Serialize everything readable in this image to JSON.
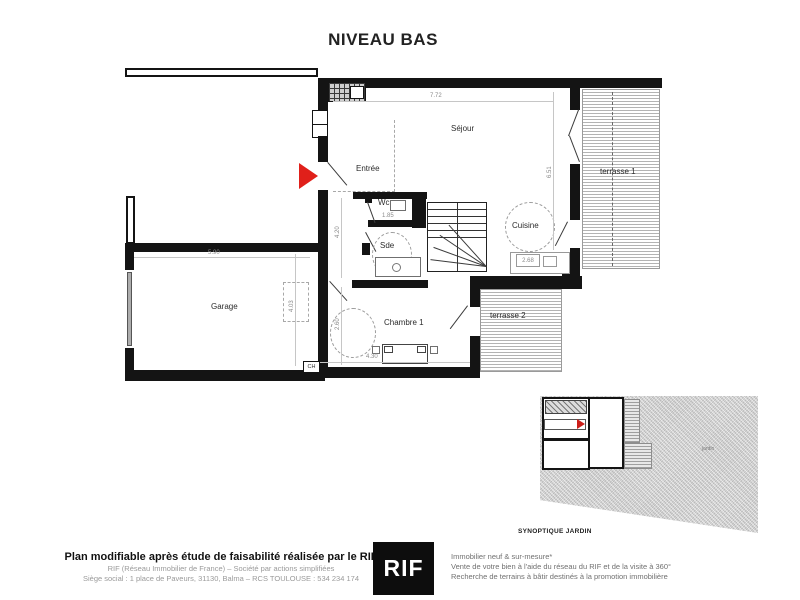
{
  "title": "NIVEAU BAS",
  "plan": {
    "rooms": {
      "sejour": "Séjour",
      "entree": "Entrée",
      "wc": "Wc",
      "sde": "Sde",
      "cuisine": "Cuisine",
      "garage": "Garage",
      "chambre1": "Chambre 1",
      "terrasse1": "terrasse 1",
      "terrasse2": "terrasse 2"
    },
    "dimensions": {
      "sejour_width": "7.72",
      "sejour_height": "6.51",
      "garage_width": "5.90",
      "entree_height": "4.20",
      "sde_width": "1.85",
      "cuisine_unit": "2.68",
      "chambre_width": "4.30",
      "chambre_height": "2.60",
      "garage_depth": "4.03"
    },
    "annotations": {
      "boiler": "CH"
    }
  },
  "inset": {
    "caption": "SYNOPTIQUE JARDIN",
    "garden_label": "jardin"
  },
  "footer": {
    "disclaimer_bold": "Plan modifiable après étude de faisabilité réalisée par le RIF",
    "company_line1": "RIF (Réseau Immobilier de France) – Société par actions simplifiées",
    "company_line2": "Siège social : 1 place de Paveurs, 31130, Balma – RCS TOULOUSE : 534 234 174",
    "logo_text": "RIF",
    "services_line1": "Immobilier neuf & sur-mesure*",
    "services_line2": "Vente de votre bien à l'aide du réseau du RIF et de la visite à 360°",
    "services_line3": "Recherche de terrains à bâtir destinés à la promotion immobilière"
  },
  "colors": {
    "entrance_arrow": "#e0201a",
    "wall": "#141414"
  }
}
